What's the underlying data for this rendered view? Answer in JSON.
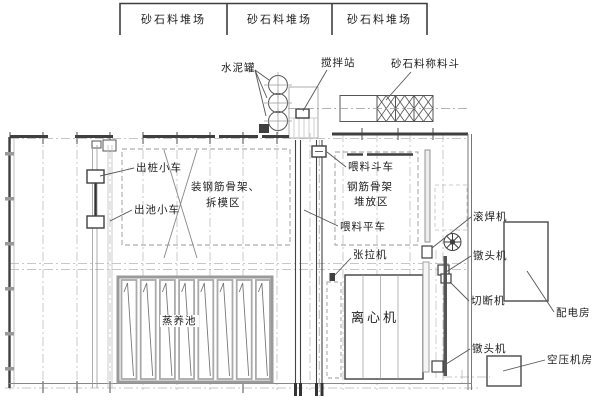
{
  "diagram": {
    "type": "factory-floor-plan",
    "stockyards": [
      {
        "label": "砂石料堆场"
      },
      {
        "label": "砂石料堆场"
      },
      {
        "label": "砂石料堆场"
      }
    ],
    "labels": {
      "cement_tank": "水泥罐",
      "mixing_station": "搅拌站",
      "aggregate_weigh_hopper": "砂石料称料斗",
      "pile_out_cart": "出桩小车",
      "pool_out_cart": "出池小车",
      "cage_assembly_demold_zone_line1": "装钢筋骨架、",
      "cage_assembly_demold_zone_line2": "拆模区",
      "feed_hopper_cart": "喂料斗车",
      "cage_storage_zone_line1": "钢筋骨架",
      "cage_storage_zone_line2": "堆放区",
      "feed_flat_cart": "喂料平车",
      "tensioning_machine": "张拉机",
      "steam_curing_pool": "蒸养池",
      "centrifuge": "离心机",
      "seam_welder": "滚焊机",
      "heading_machine_top": "镦头机",
      "cutting_machine": "切断机",
      "power_distribution_room": "配电房",
      "heading_machine_bottom": "镦头机",
      "air_compressor_room": "空压机房"
    },
    "colors": {
      "line_dark": "#3f3f3f",
      "line_gray": "#999999",
      "background": "#ffffff"
    }
  }
}
